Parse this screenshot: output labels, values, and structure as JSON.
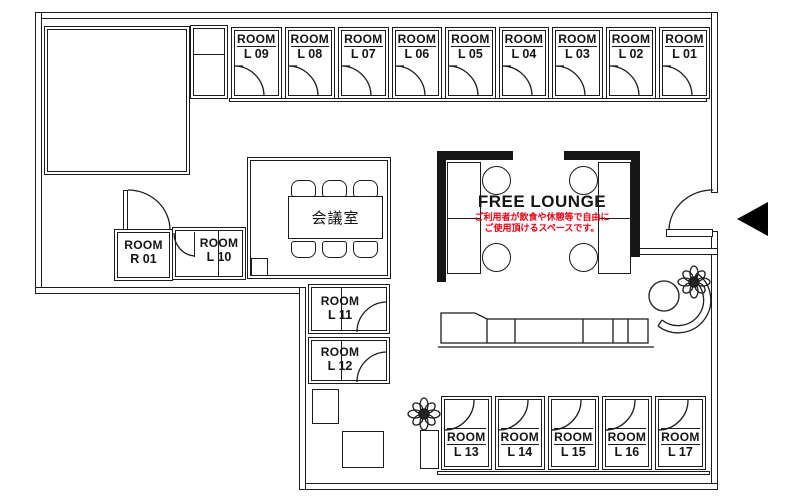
{
  "labels": {
    "room_word": "ROOM",
    "meeting_room": "会議室",
    "lounge_title": "FREE LOUNGE",
    "lounge_desc1": "ご利用者が飲食や休憩等で自由に",
    "lounge_desc2": "ご使用頂けるスペースです。"
  },
  "rooms": {
    "top": [
      "L 09",
      "L 08",
      "L 07",
      "L 06",
      "L 05",
      "L 04",
      "L 03",
      "L 02",
      "L 01"
    ],
    "bottom": [
      "L 13",
      "L 14",
      "L 15",
      "L 16",
      "L 17"
    ],
    "left_single": "R 01",
    "left_slide": "L 10",
    "mid": [
      "L 11",
      "L 12"
    ]
  },
  "colors": {
    "line": "#1b1b1b",
    "accent_red": "#e60012"
  }
}
